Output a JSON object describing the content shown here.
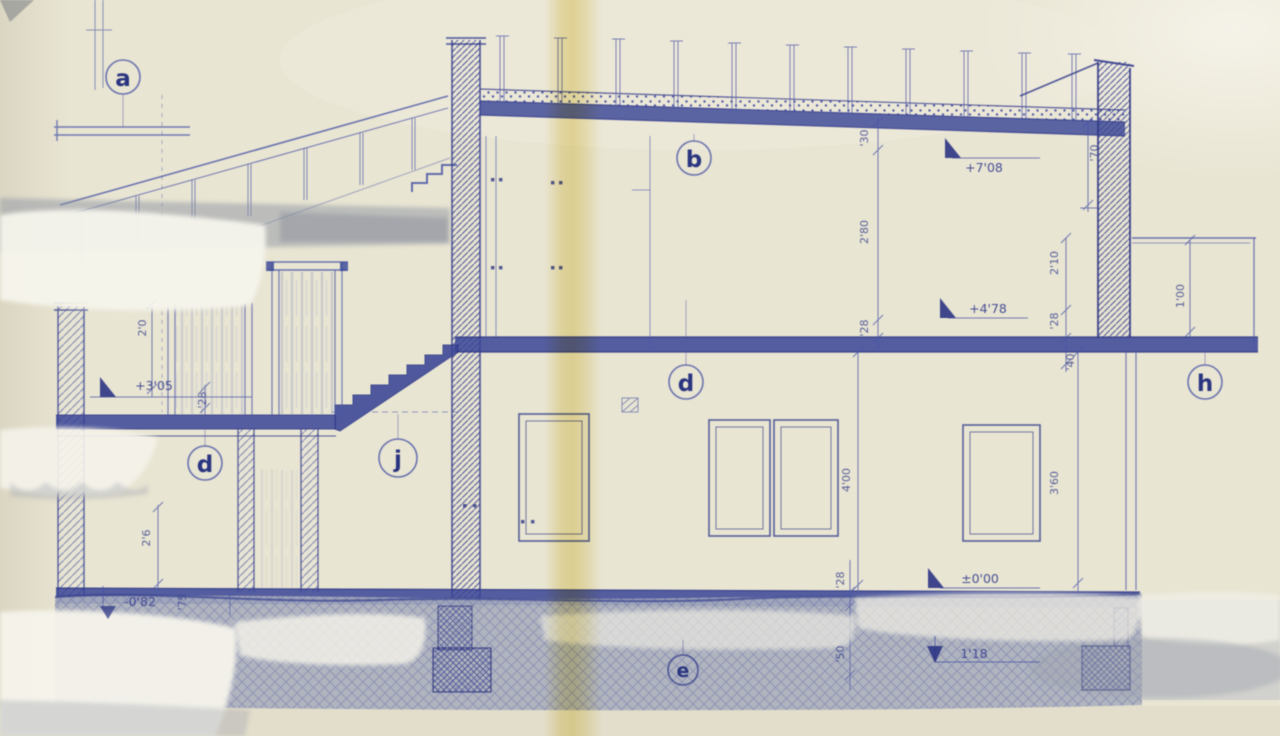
{
  "drawing": {
    "markers": {
      "a": "a",
      "b": "b",
      "d": "d",
      "j": "j",
      "h": "h",
      "e": "e"
    },
    "levels": {
      "roof": "+7'08",
      "upper_floor": "+4'78",
      "terrace": "+3'05",
      "ground": "±0'00",
      "foundation": "1'18",
      "lower_ground": "-0'82"
    },
    "dimensions": {
      "parapet_height": "'30",
      "upper_room_height": "2'80",
      "upper_slab": "'28",
      "roof_edge": "'70",
      "annex_clear": "2'10",
      "annex_slab": "'28",
      "annex_beam": "'40",
      "annex_depth": "1'00",
      "room_height_left": "4'00",
      "room_height_right": "3'60",
      "ground_slab": "'28",
      "footing_depth": "'50",
      "terrace_parapet": "2'0",
      "terrace_slab": "'28",
      "left_post": "2'6",
      "left_offset": "'75"
    }
  },
  "palette": {
    "paper": "#e9e5d3",
    "ink": "#333c8c",
    "ink_light": "#5b67ab",
    "fold_yellow": "#e6d26e",
    "terrain_gray": "#a9aebc",
    "smudge_gray": "#8f95a3",
    "patch_white": "#f6f4ec"
  }
}
